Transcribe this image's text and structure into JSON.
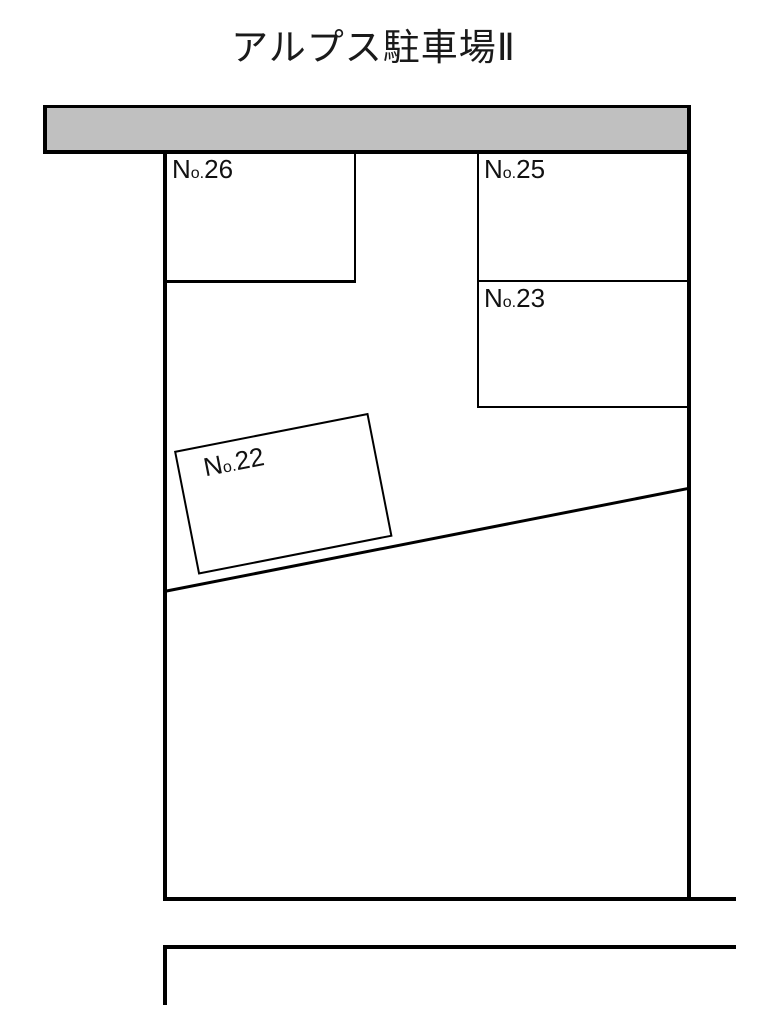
{
  "title": "アルプス駐車場Ⅱ",
  "colors": {
    "background": "#ffffff",
    "line": "#000000",
    "road_fill": "#c0c0c0",
    "text": "#1a1a1a"
  },
  "spaces": {
    "s26": {
      "prefix_large": "N",
      "prefix_small": "o.",
      "number": "26"
    },
    "s25": {
      "prefix_large": "N",
      "prefix_small": "o.",
      "number": "25"
    },
    "s23": {
      "prefix_large": "N",
      "prefix_small": "o.",
      "number": "23"
    },
    "s22": {
      "prefix_large": "N",
      "prefix_small": "o.",
      "number": "22"
    }
  }
}
